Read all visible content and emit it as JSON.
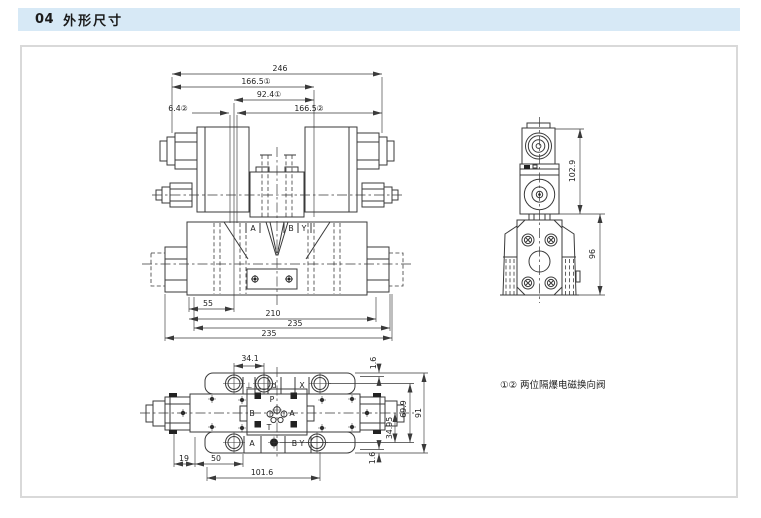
{
  "header": {
    "number": "04",
    "title": "外形尺寸"
  },
  "note": {
    "text": "①② 两位隔爆电磁换向阀"
  },
  "colors": {
    "header_bg": "#d7e9f6",
    "line": "#3a3a3a",
    "sheet_border": "#d9d9d9"
  },
  "front_view": {
    "dim_total_width": "246",
    "dim_166_5_1": "166.5①",
    "dim_92_4_1": "92.4①",
    "dim_6_4_2": "6.4②",
    "dim_166_5_2": "166.5②",
    "dim_55": "55",
    "dim_210": "210",
    "dim_235_upper": "235",
    "dim_235_lower": "235",
    "port_a": "A",
    "port_b": "B",
    "port_y": "Y"
  },
  "side_view": {
    "dim_height_upper": "102.9",
    "dim_height_body": "96"
  },
  "top_view": {
    "dim_34_1": "34.1",
    "dim_1_6_top": "1.6",
    "dim_91": "91",
    "dim_69_9": "69.9",
    "dim_34_95": "34.95",
    "dim_1_6_bottom": "1.6",
    "dim_19": "19",
    "dim_50": "50",
    "dim_101_6": "101.6",
    "port_l": "⊥",
    "port_d": "d",
    "port_x": "X",
    "port_p": "P",
    "port_b_center": "B",
    "port_a_center": "A",
    "port_t": "T",
    "port_a_bottom": "A",
    "port_by_bottom": "B Y"
  }
}
